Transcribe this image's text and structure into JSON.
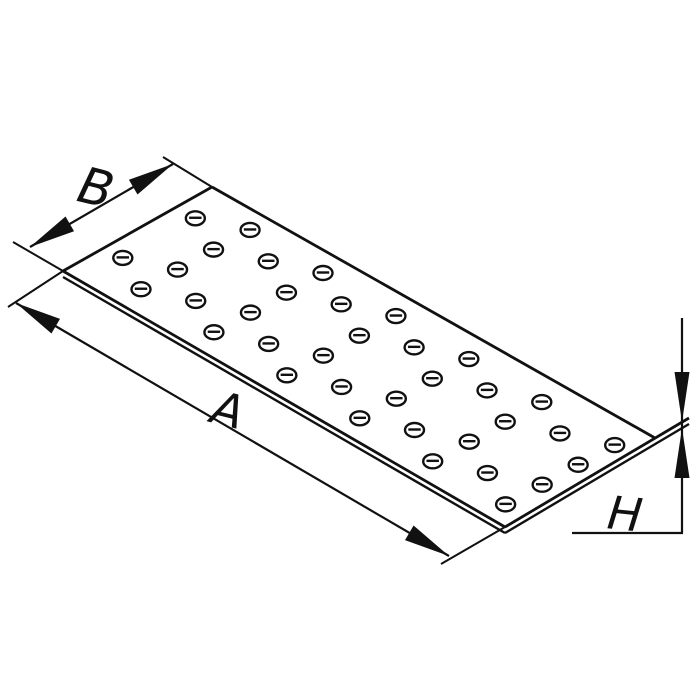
{
  "title": "Perforated flat connector plate — dimensional drawing",
  "labels": {
    "length": "A",
    "width": "B",
    "thickness": "H"
  },
  "colors": {
    "ink": "#111111",
    "paper": "#ffffff"
  },
  "drawing": {
    "corners": {
      "top": [
        212,
        187
      ],
      "right": [
        655,
        438
      ],
      "bottom": [
        505,
        527
      ],
      "left": [
        63,
        271
      ]
    },
    "thickness_px": 6,
    "stroke": {
      "outline": 2.8,
      "lower_edge": 2.4,
      "dim": 2.2,
      "ext": 2.0,
      "hole": 2.4
    },
    "holes": {
      "origin": [
        323,
        273
      ],
      "u_vec": [
        0.861,
        0.508
      ],
      "w_vec": [
        -0.508,
        0.861
      ],
      "pitch": 84.7,
      "group_shift": 42.35,
      "step_along": 31.6,
      "step_across": 17.75,
      "group_across": 71,
      "k_min": -3,
      "k_max": 4,
      "rx": 9.5,
      "ry": 7,
      "bar_half": 6.2,
      "margin": 13
    },
    "dim_b": {
      "tip_left": [
        30,
        247
      ],
      "tip_right": [
        173,
        164
      ],
      "ext_left": [
        [
          13,
          242
        ],
        [
          63,
          271
        ]
      ],
      "ext_right": [
        [
          163,
          157
        ],
        [
          212,
          187
        ]
      ],
      "label_x": 96,
      "label_y": 205,
      "label_rot": 14,
      "font_size": 50
    },
    "dim_a": {
      "tip_top": [
        16,
        303
      ],
      "tip_bottom": [
        449,
        556
      ],
      "ext_top": [
        [
          8,
          307
        ],
        [
          63,
          271
        ]
      ],
      "ext_bottom": [
        [
          441,
          564
        ],
        [
          505,
          527
        ]
      ],
      "label_x": 228,
      "label_y": 426,
      "label_rot": 14,
      "font_size": 46
    },
    "dim_h": {
      "vline": [
        [
          682,
          318
        ],
        [
          682,
          533
        ]
      ],
      "hline": [
        [
          572,
          533
        ],
        [
          683,
          533
        ]
      ],
      "upper_tip": [
        682,
        422
      ],
      "lower_tip": [
        682,
        428
      ],
      "arrow_len": 50,
      "arrow_half_width": 7.5,
      "edge_ext_upper_end": [
        689,
        418
      ],
      "edge_ext_lower_end": [
        689,
        424
      ],
      "label_x": 625,
      "label_y": 530,
      "label_rot": 6,
      "font_size": 46
    },
    "arrow": {
      "len": 46,
      "half_width": 8.5
    }
  }
}
